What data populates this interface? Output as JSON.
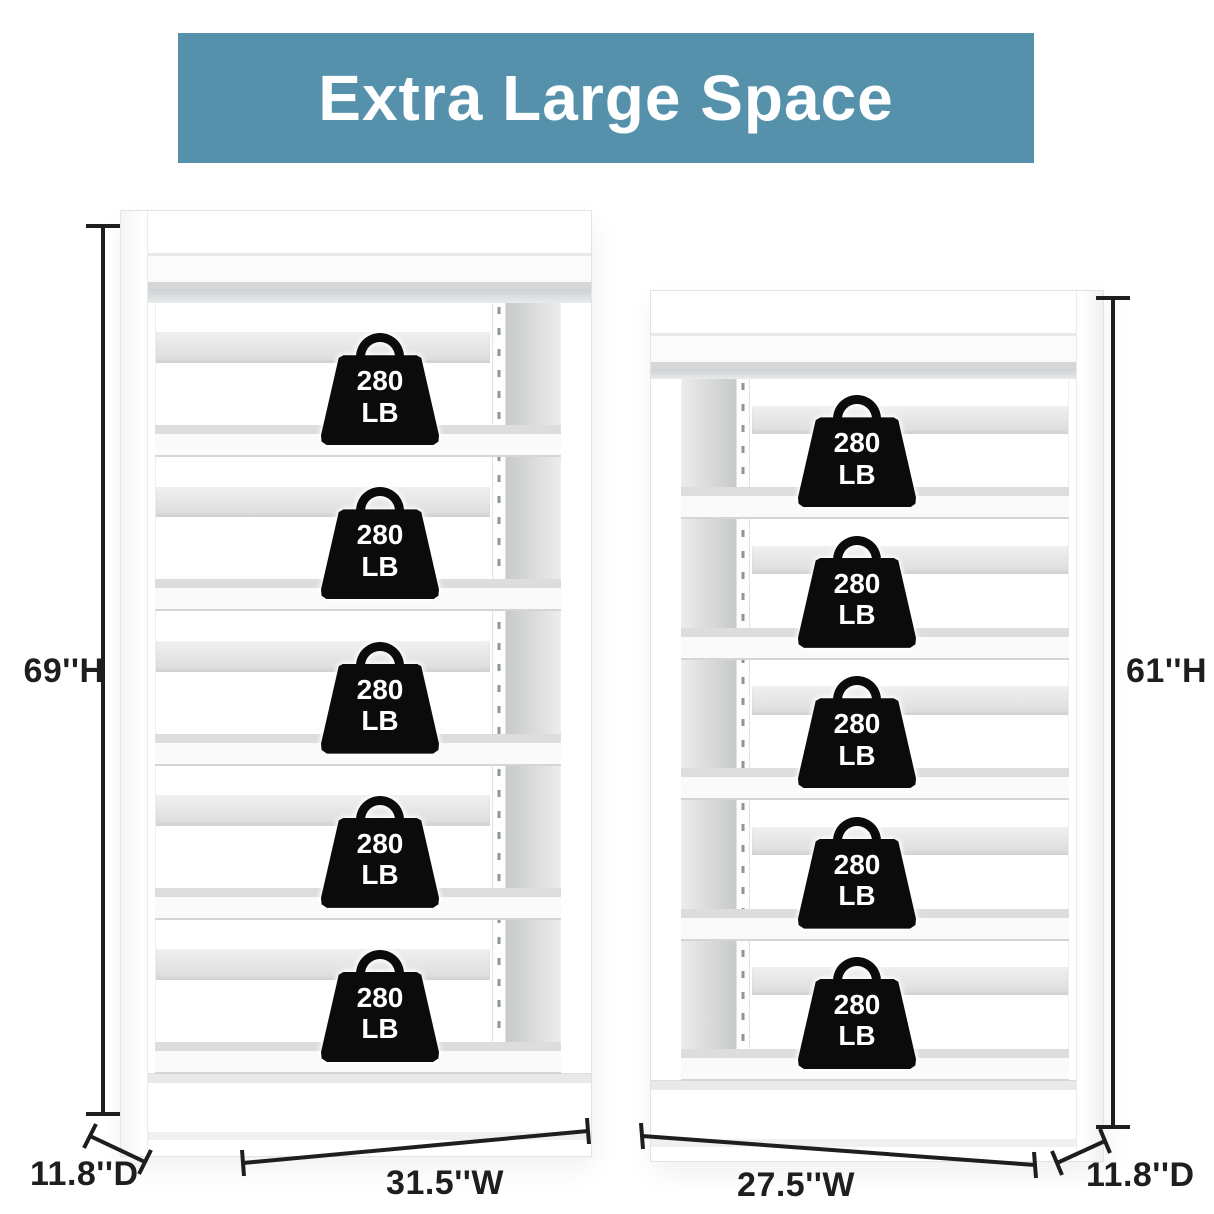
{
  "banner": {
    "title": "Extra Large Space"
  },
  "colors": {
    "banner_bg": "#5591ab",
    "banner_text": "#ffffff",
    "weight_bg": "#0b0b0b",
    "weight_text": "#ffffff",
    "dimension_color": "#1e1e1e",
    "shelf_color": "#ffffff"
  },
  "units": {
    "left": {
      "height_label": "69''H",
      "width_label": "31.5''W",
      "depth_label": "11.8''D",
      "shelf_count": 5,
      "weights": [
        {
          "value": "280",
          "unit": "LB"
        },
        {
          "value": "280",
          "unit": "LB"
        },
        {
          "value": "280",
          "unit": "LB"
        },
        {
          "value": "280",
          "unit": "LB"
        },
        {
          "value": "280",
          "unit": "LB"
        }
      ]
    },
    "right": {
      "height_label": "61''H",
      "width_label": "27.5''W",
      "depth_label": "11.8''D",
      "shelf_count": 5,
      "weights": [
        {
          "value": "280",
          "unit": "LB"
        },
        {
          "value": "280",
          "unit": "LB"
        },
        {
          "value": "280",
          "unit": "LB"
        },
        {
          "value": "280",
          "unit": "LB"
        },
        {
          "value": "280",
          "unit": "LB"
        }
      ]
    }
  }
}
